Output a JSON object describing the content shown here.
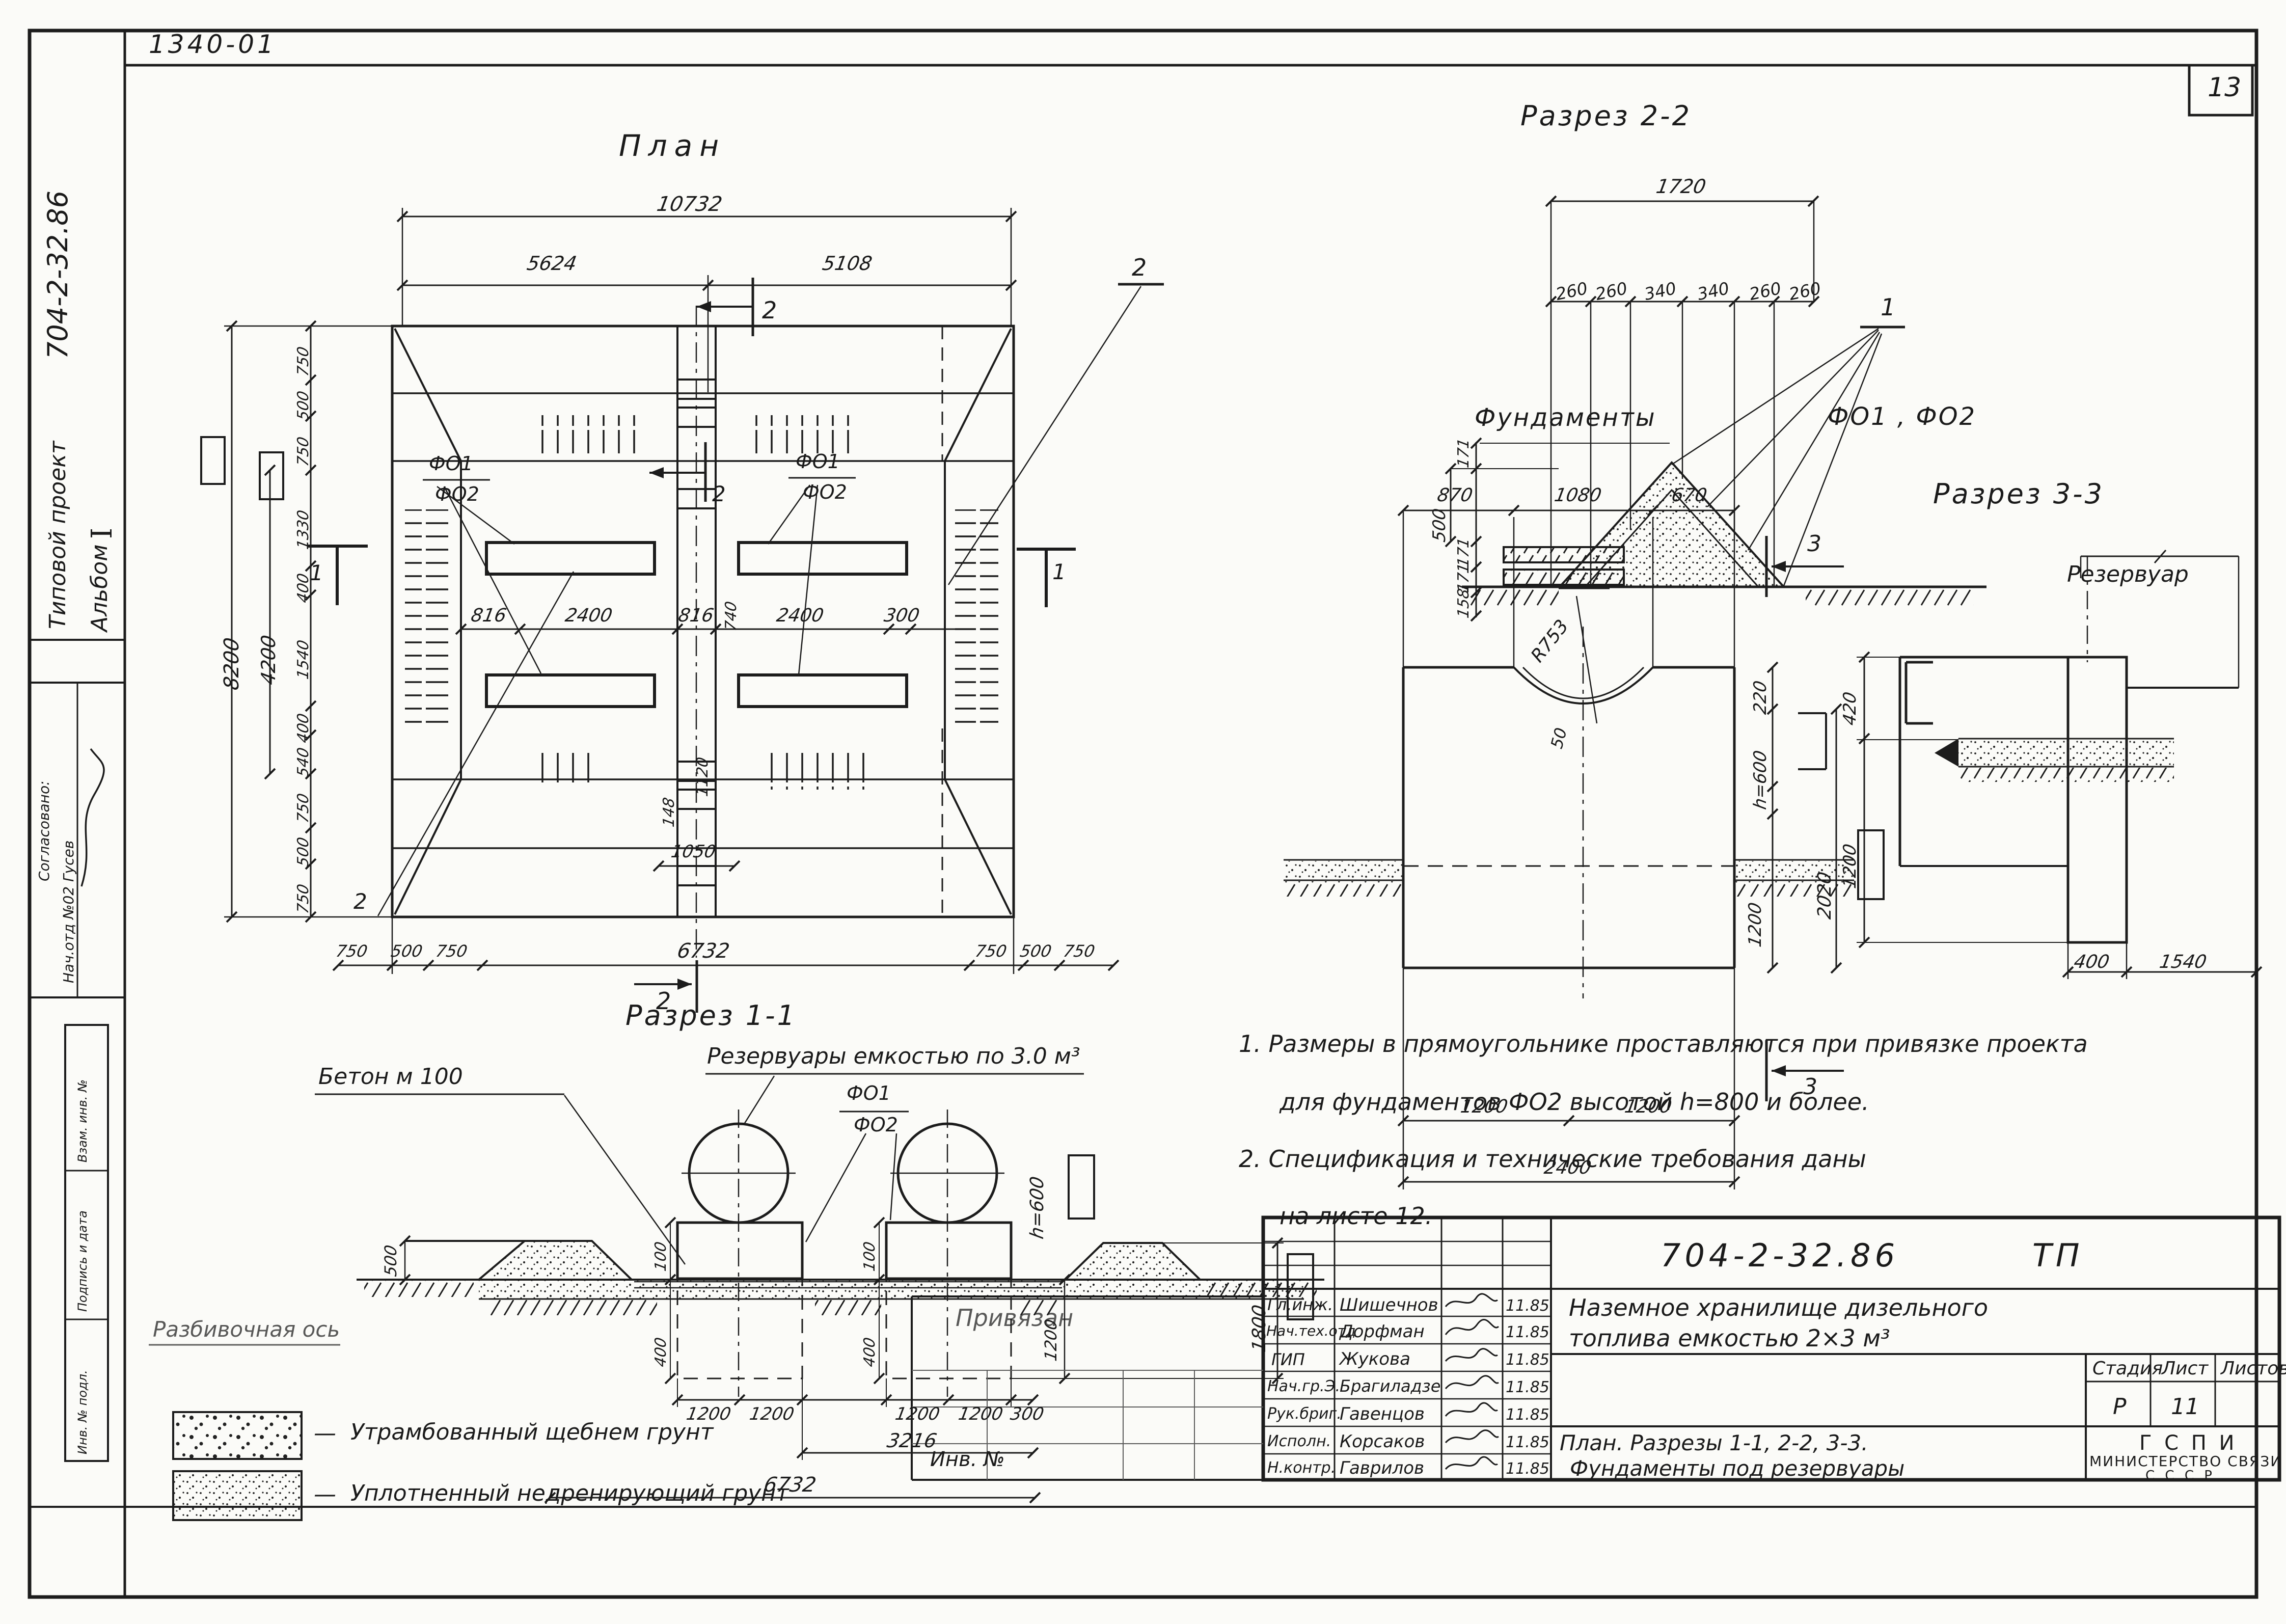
{
  "page": {
    "sheet_number": "13",
    "top_code": "1340-01"
  },
  "sidebar": {
    "project_label": "Типовой проект",
    "project_number": "704-2-32.86",
    "album_label": "Альбом",
    "album_number": "I",
    "agreed": "Согласовано:",
    "agreed_by": "Нач.отд №02 Гусев",
    "fields": [
      "Взам. инв. №",
      "Подпись и дата",
      "Инв. № подл."
    ]
  },
  "plan": {
    "title": "План",
    "dim_total_top": "10732",
    "dim_left_top": "5624",
    "dim_right_top": "5108",
    "dim_height": "8200",
    "dim_inner_height": "4200",
    "left_chain": [
      "750",
      "500",
      "750",
      "1330",
      "400",
      "1540",
      "400",
      "540",
      "750",
      "500",
      "750"
    ],
    "mid_chain": [
      "816",
      "2400",
      "816",
      "2400",
      "300"
    ],
    "strip_dims": [
      "740",
      "1120",
      "148",
      "1050"
    ],
    "bottom_chain": [
      "750",
      "500",
      "750",
      "6732",
      "750",
      "500",
      "750"
    ],
    "f1": "ФО1",
    "f2": "ФО2",
    "marker1": "1",
    "marker2": "2"
  },
  "section22": {
    "title": "Разрез 2-2",
    "dim_top": "1720",
    "top_chain": [
      "260",
      "260",
      "340",
      "340",
      "260",
      "260"
    ],
    "left_chain": [
      "171",
      "500",
      "171",
      "171",
      "158"
    ],
    "marker": "1"
  },
  "foundations": {
    "title_word": "Фундаменты",
    "title_marks": "ФО1 , ФО2",
    "top_chain": [
      "870",
      "1080",
      "670"
    ],
    "radius": "R753",
    "gap": "50",
    "right_dims": [
      "220",
      "h=600",
      "1200",
      "2020"
    ],
    "bottom_chain": [
      "1200",
      "1200"
    ],
    "dim_total_bottom": "2400",
    "marker": "3"
  },
  "section33": {
    "title": "Разрез 3-3",
    "tank_label": "Резервуар",
    "left_dims": [
      "420",
      "1200"
    ],
    "bottom_dims": [
      "400",
      "1540"
    ]
  },
  "section11": {
    "title": "Разрез 1-1",
    "tanks_label": "Резервуары  емкостью  по 3.0 м³",
    "concrete_label": "Бетон  м 100",
    "f1": "ФО1",
    "f2": "ФО2",
    "dim_500": "500",
    "ped_dims": [
      "100",
      "400"
    ],
    "h600": "h=600",
    "dim_1200_right": "1200",
    "dim_1800": "1800",
    "bottom_chain": [
      "1200",
      "1200",
      "1200",
      "1200",
      "300"
    ],
    "dim_3216": "3216",
    "dim_total": "6732",
    "axis_label": "Разбивочная  ось"
  },
  "legend": {
    "items": [
      {
        "dash": "—",
        "label": "Утрамбованный  щебнем  грунт"
      },
      {
        "dash": "—",
        "label": "Уплотненный  недренирующий  грунт"
      }
    ]
  },
  "notes": {
    "lines": [
      "1. Размеры  в  прямоугольнике  проставляются  при  привязке  проекта",
      "для  фундаментов  ФО2  высотой  h=800  и  более.",
      "2. Спецификация   и  технические   требования   даны",
      "на  листе  12."
    ]
  },
  "titleblock": {
    "doc_code": "704-2-32.86",
    "doc_type": "ТП",
    "title_line1": "Наземное  хранилище  дизельного",
    "title_line2": "топлива   емкостью   2×3 м³",
    "content_line1": "План. Разрезы 1-1, 2-2, 3-3.",
    "content_line2": "Фундаменты  под  резервуары",
    "org_line1": "Г С П И",
    "org_line2": "МИНИСТЕРСТВО  СВЯЗИ",
    "org_line3": "С С С Р",
    "stage_label": "Стадия",
    "sheet_label": "Лист",
    "sheets_label": "Листов",
    "stage_value": "Р",
    "sheet_value": "11",
    "sheets_value": "",
    "rows": [
      {
        "role": "Гл.инж.",
        "name": "Шишечнов",
        "date": "11.85"
      },
      {
        "role": "Нач.тех.отд",
        "name": "Дорфман",
        "date": "11.85"
      },
      {
        "role": "ГИП",
        "name": "Жукова",
        "date": "11.85"
      },
      {
        "role": "Нач.гр.Э.",
        "name": "Брагиладзе",
        "date": "11.85"
      },
      {
        "role": "Рук.бриг.",
        "name": "Гавенцов",
        "date": "11.85"
      },
      {
        "role": "Исполн.",
        "name": "Корсаков",
        "date": "11.85"
      },
      {
        "role": "Н.контр.",
        "name": "Гаврилов",
        "date": "11.85"
      }
    ],
    "stamp": {
      "note": "Привязан",
      "inv_label": "Инв. №"
    }
  }
}
